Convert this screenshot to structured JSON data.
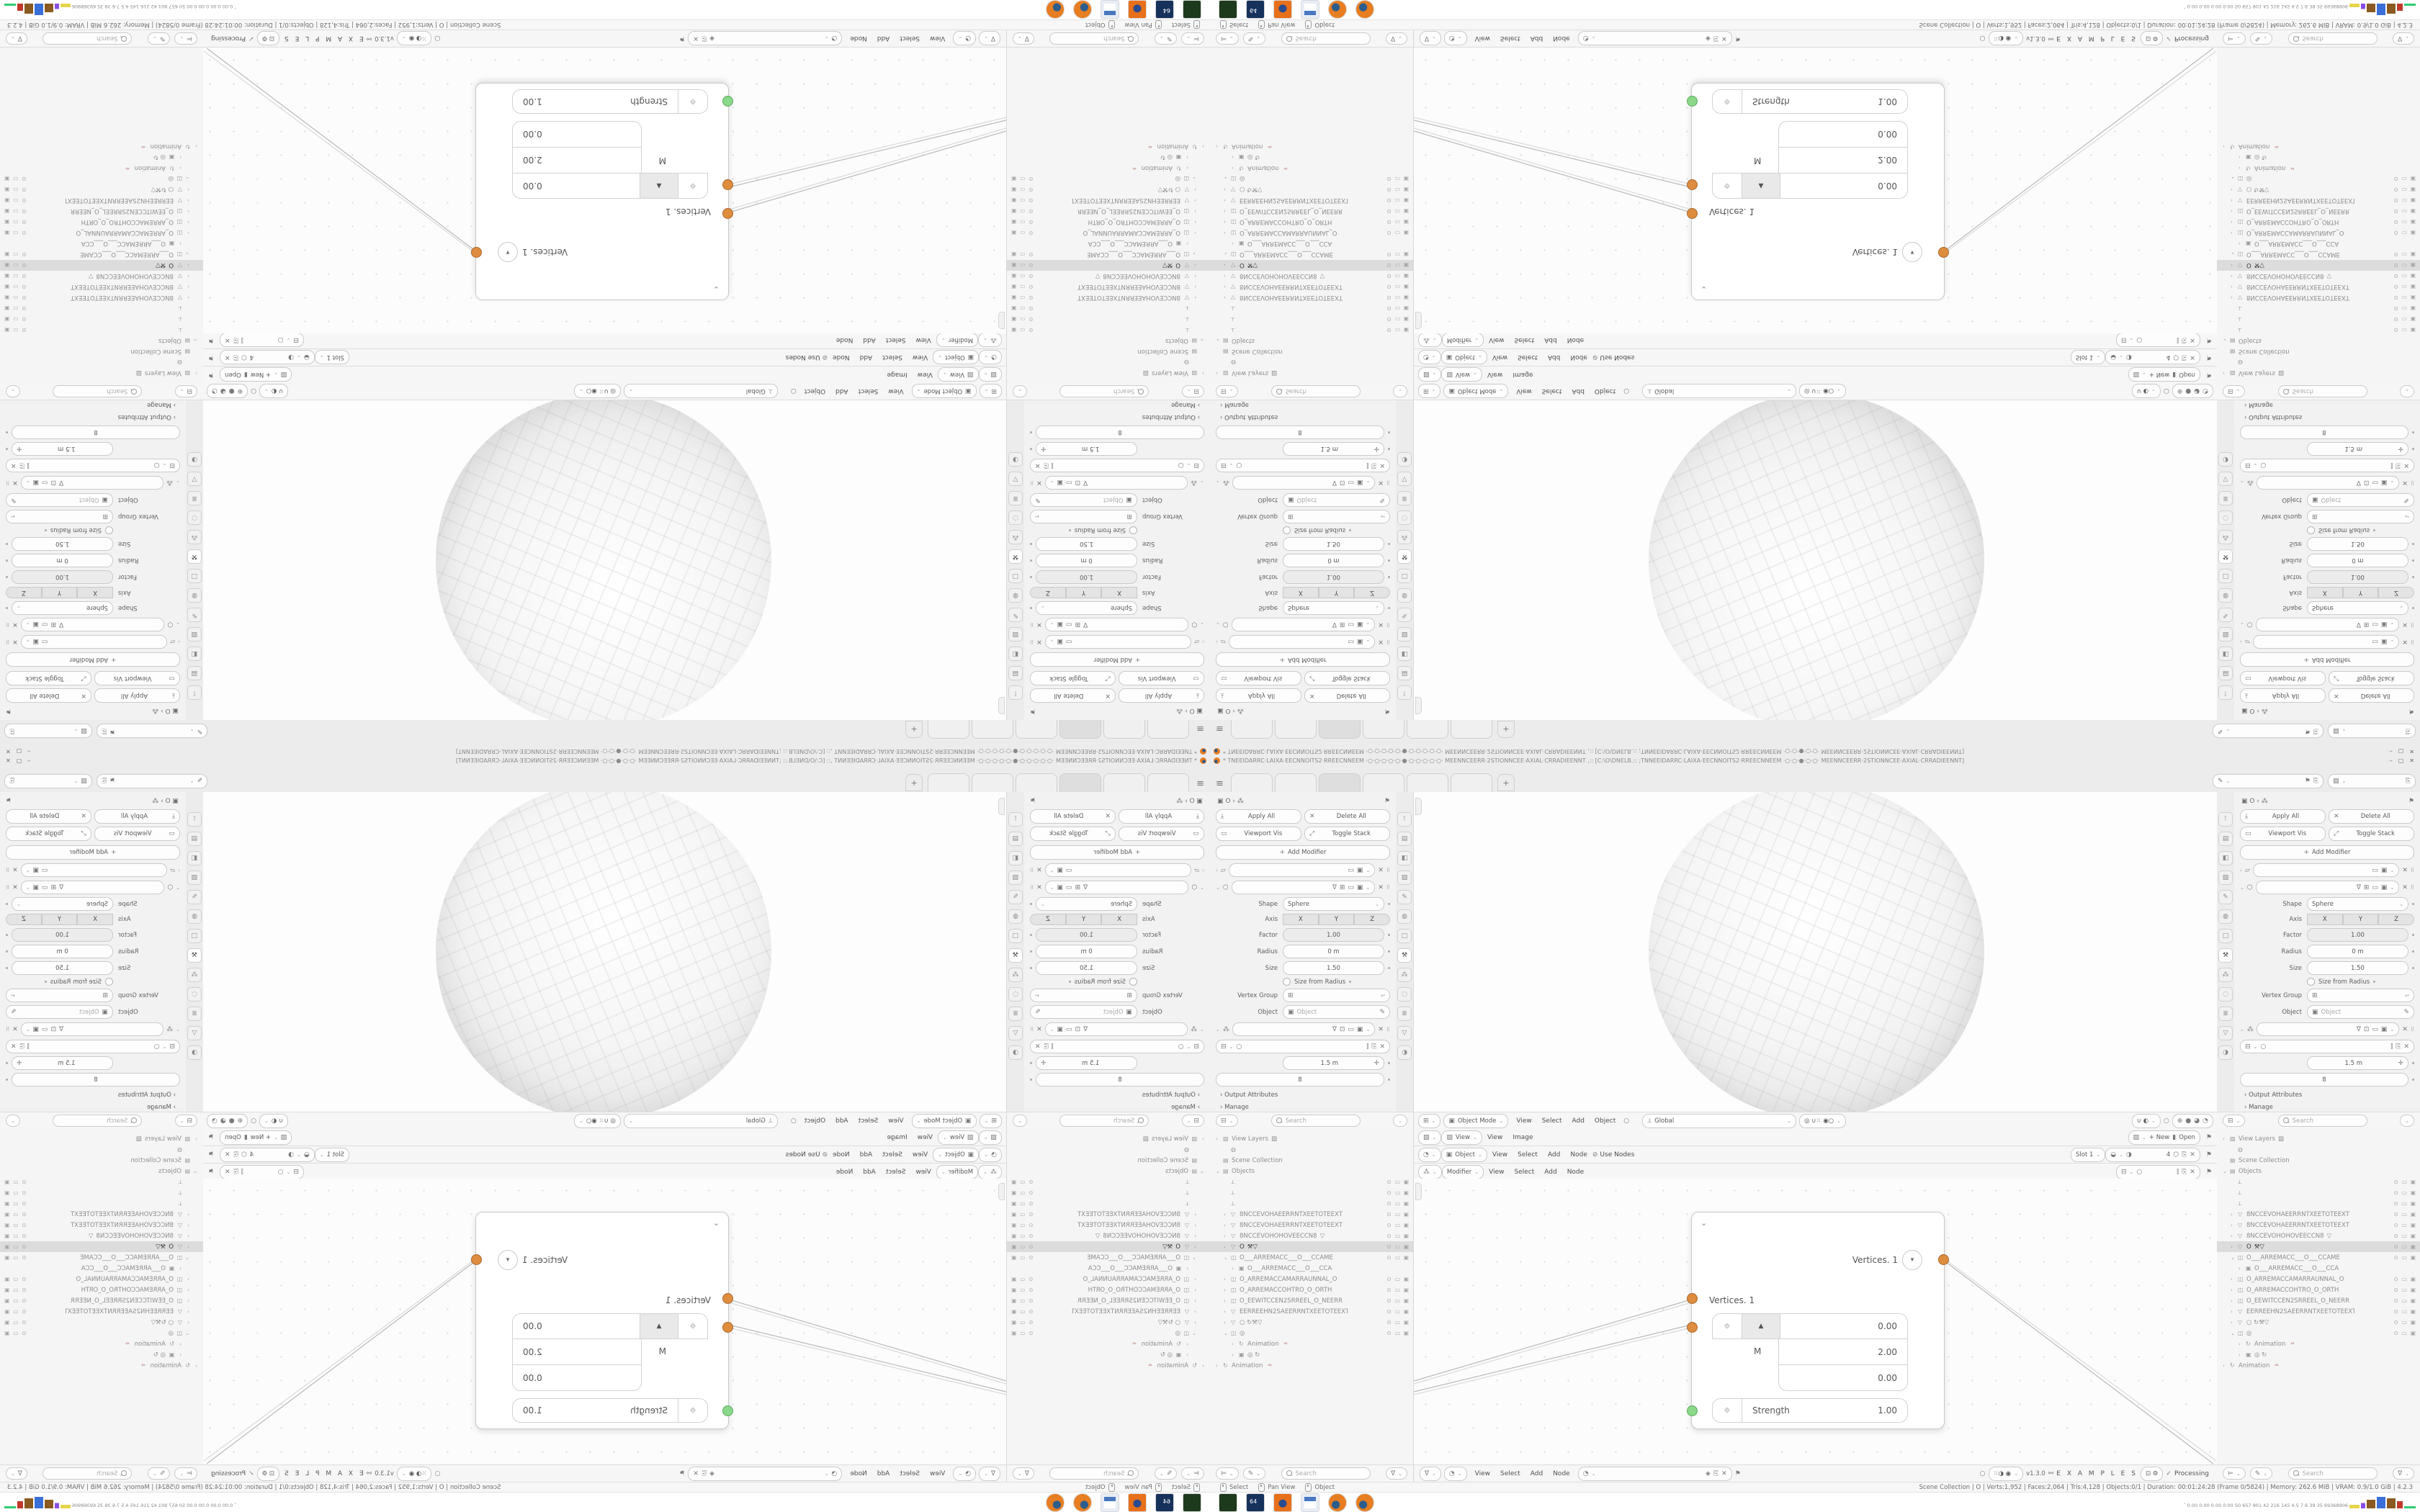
{
  "window": {
    "title": "* TNEEIDARRC·LAIXA·EECNNOITS2·RREECNNEEM ·○·○·○·○·○·●·○·○·○·○·○· MEENNCEERR·2STIONNCEE·AXIAL·CRRADIEENNT ,:: [C:\\O\\DNELB.:: ;TNNEEIDARRC·LAIXA·EECNNOITS2·RREECNNEEM ·○·○·●·○·○· MEENNCEERR·2STIONNCEE·AXIAL·CRRADIEENNT]",
    "minimize": "–",
    "maximize": "▢",
    "close": "✕"
  },
  "topbar": {
    "hamburger": "≡",
    "add_tab": "+",
    "tabs": [
      {
        "a": 0
      },
      {
        "a": 0
      },
      {
        "a": 1
      },
      {
        "a": 0
      },
      {
        "a": 0
      },
      {
        "a": 0
      }
    ],
    "scene_field_icon": "✎",
    "layer_field_icon": "▨",
    "pin": "⚑",
    "dup": "⎘"
  },
  "props": {
    "crumb": {
      "icons": "▣  O  ›  ⁂",
      "pin": "⚑"
    },
    "apply_all": "Apply All",
    "delete_all": "Delete All",
    "viewport_vis": "Viewport Vis",
    "toggle_stack": "Toggle Stack",
    "add_modifier": "Add Modifier",
    "shape_label": "Shape",
    "shape_value": "Sphere",
    "axis_label": "Axis",
    "axis": [
      {
        "g": "X"
      },
      {
        "g": "Y"
      },
      {
        "g": "Z"
      }
    ],
    "factor_label": "Factor",
    "factor": "1.00",
    "radius_label": "Radius",
    "radius": "0 m",
    "size_label": "Size",
    "size": "1.50",
    "size_from_radius": "Size from Radius",
    "vertex_group_label": "Vertex Group",
    "object_label": "Object",
    "object_placeholder": "Object",
    "length_value": "1.5 m",
    "count_value": "8",
    "output_attributes": "› Output Attributes",
    "manage": "› Manage",
    "search_placeholder": "Search",
    "nav": [
      {
        "g": "⊺"
      },
      {
        "g": "▤"
      },
      {
        "g": "◧"
      },
      {
        "g": "▨"
      },
      {
        "g": "✎"
      },
      {
        "g": "◍"
      },
      {
        "g": "□"
      },
      {
        "g": "⚒",
        "a": 1
      },
      {
        "g": "⁂"
      },
      {
        "g": "◌"
      },
      {
        "g": "≣"
      },
      {
        "g": "▽"
      },
      {
        "g": "◑"
      }
    ]
  },
  "viewport": {
    "editor_icon": "⊞",
    "mode": "Object Mode",
    "menus": [
      {
        "g": "View"
      },
      {
        "g": "Select"
      },
      {
        "g": "Add"
      },
      {
        "g": "Object"
      }
    ],
    "orientation": "Global",
    "orient_icon": "⟂",
    "snap_icons": "◎  ∪⁙  ◉○",
    "shading": [
      {
        "g": "⊕",
        "a": 0
      },
      {
        "g": "●",
        "a": 1
      },
      {
        "g": "◕",
        "a": 0
      },
      {
        "g": "◔",
        "a": 0
      }
    ],
    "gizmo_icons": "∪  ◐"
  },
  "headers": {
    "image": {
      "tic": "▨",
      "context": "View",
      "m1": "View",
      "m2": "Image",
      "new_btn": "+ New",
      "open_btn": "Open",
      "pin": "⚑"
    },
    "shader": {
      "tic": "◔",
      "context": "Object",
      "menus": [
        {
          "g": "View"
        },
        {
          "g": "Select"
        },
        {
          "g": "Add"
        },
        {
          "g": "Node"
        }
      ],
      "use_nodes": "Use Nodes",
      "slot": "Slot 1",
      "name_icon": "◑",
      "badge": "4",
      "pin": "⚑"
    },
    "geonodes": {
      "tic": "⁂",
      "context": "Modifier",
      "menus": [
        {
          "g": "View"
        },
        {
          "g": "Select"
        },
        {
          "g": "Add"
        },
        {
          "g": "Node"
        }
      ],
      "pin": "⚑"
    },
    "nodeed": {
      "tic1": "∇",
      "tic2": "◔",
      "menus": [
        {
          "g": "View"
        },
        {
          "g": "Select"
        },
        {
          "g": "Add"
        },
        {
          "g": "Node"
        }
      ],
      "shield": "◈",
      "dup": "⎘",
      "x": "✕",
      "pin": "⚑",
      "dot": "○",
      "toggles": "⁙◑  ◉",
      "version": "v1.3.0",
      "dna": "⚯",
      "examples": "E X A M P L E S",
      "grid": "⊡ ⚙",
      "processing_check": "✓",
      "processing": "Processing"
    }
  },
  "node": {
    "collapse": "⌄",
    "title": "Vertices. 1",
    "title_btn": "▾",
    "input_label": "Vertices. 1",
    "vec_icon": "⟐",
    "stepper": "▲",
    "m_label": "M",
    "values": [
      {
        "g": "0.00"
      },
      {
        "g": "2.00"
      },
      {
        "g": "0.00"
      }
    ],
    "strength_label": "Strength",
    "strength_value": "1.00",
    "strength_icon": "⟐"
  },
  "outliner": {
    "filter_icon": "∇",
    "mode_icon": "⊨",
    "brush_icon": "✎",
    "search_placeholder": "Search",
    "rows": [
      {
        "c": "›",
        "i": "▨",
        "l": "View Layers",
        "r": "▨",
        "ind": 0
      },
      {
        "c": "",
        "i": "◍",
        "l": "",
        "ind": 1
      },
      {
        "c": "",
        "i": "▤",
        "l": "Scene Collection",
        "ind": 0
      },
      {
        "c": "⌄",
        "i": "▤",
        "l": "Objects",
        "ind": 0
      },
      {
        "c": "",
        "i": "⟂",
        "l": "",
        "t": 1,
        "ind": 1
      },
      {
        "c": "",
        "i": "⟂",
        "l": "",
        "t": 1,
        "ind": 1
      },
      {
        "c": "",
        "i": "⟂",
        "l": "",
        "t": 1,
        "ind": 1
      },
      {
        "c": "›",
        "i": "▽",
        "l": "8NCCEVOHAEERRNTXEETOTEEXT",
        "t": 1,
        "ind": 1
      },
      {
        "c": "›",
        "i": "▽",
        "l": "8NCCEVOHAEERRNTXEETOTEEXT",
        "t": 1,
        "ind": 1
      },
      {
        "c": "›",
        "i": "▽",
        "l": "8NCCEVOHOHOVEECCN8",
        "r": "▽",
        "t": 1,
        "ind": 1
      },
      {
        "c": "›",
        "i": "▽",
        "l": "O",
        "r": "⚒▽",
        "t": 1,
        "sel": 1,
        "ind": 1
      },
      {
        "c": "⌄",
        "i": "◫",
        "l": "O___ARREMACC___O___CCAME",
        "t": 1,
        "ind": 1
      },
      {
        "c": "›",
        "i": "▣",
        "l": "O___ARREMACC___O___CCA",
        "ind": 2
      },
      {
        "c": "›",
        "i": "◫",
        "l": "O_ARREMACCAMARRAUNNAL_O",
        "t": 1,
        "ind": 1
      },
      {
        "c": "›",
        "i": "◫",
        "l": "O_ARREMACCOHTRO_O_ORTH",
        "t": 1,
        "ind": 1
      },
      {
        "c": "›",
        "i": "◫",
        "l": "O_EEWITCCEN2SRREEL_O_NEERR",
        "t": 1,
        "ind": 1
      },
      {
        "c": "›",
        "i": "▽",
        "l": "EERREEHN2SAEERRNTXEETOTEEXT",
        "t": 1,
        "ind": 1
      },
      {
        "c": "›",
        "i": "▽",
        "l": "○  ↻⚒▽",
        "t": 1,
        "ind": 1
      },
      {
        "c": "⌄",
        "i": "◫",
        "l": "◎",
        "t": 1,
        "ind": 1
      },
      {
        "c": "›",
        "i": "↻",
        "l": "Animation",
        "b": "⁴²",
        "ind": 2
      },
      {
        "c": "›",
        "i": "▣",
        "l": "◎ ↻",
        "ind": 2
      },
      {
        "c": "›",
        "i": "↻",
        "l": "Animation",
        "b": "⁴²",
        "ind": 0
      }
    ],
    "toggle_eye": "⊙",
    "toggle_mon": "▭",
    "toggle_cam": "▣"
  },
  "statusbar": {
    "hints": [
      {
        "l": "Select"
      },
      {
        "l": "Pan View"
      },
      {
        "l": "Object"
      }
    ],
    "stats": "Scene Collection | O | Verts:1,952 | Faces:2,064 | Tris:4,128 | Objects:0/1 | Duration: 00:01:24:28 (Frame 0/5824) | Memory: 262.6 MiB | VRAM: 0.9/1.0 GiB | 4.2.3"
  },
  "taskbar": {
    "apps": [
      {
        "k": "rec"
      },
      {
        "k": "save"
      },
      {
        "k": "fox"
      },
      {
        "k": "calc"
      },
      {
        "k": "blend"
      },
      {
        "k": "blend"
      }
    ],
    "tray_chevron": "ˆ",
    "tray_stats": "0.00 0.00 0.00 0.00  50  657  901  42  216  145  4.5  7.6  39  35  69368906"
  }
}
